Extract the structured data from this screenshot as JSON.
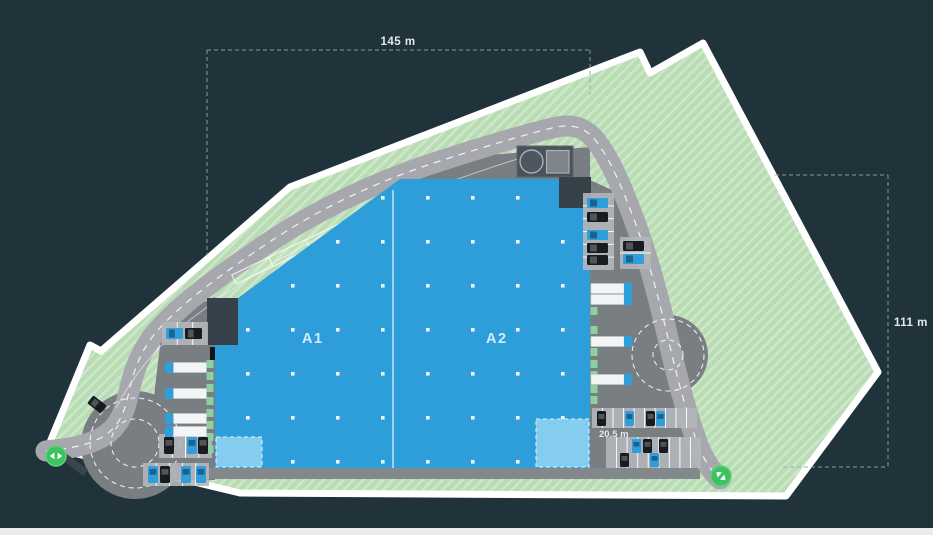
{
  "labels": {
    "dim_top": "145 m",
    "dim_right": "111 m",
    "dim_parking": "20.5 m",
    "hall_a1": "A1",
    "hall_a2": "A2"
  },
  "colors": {
    "bg": "#20323a",
    "boundary": "#ffffff",
    "green": "#b9dcb5",
    "green-light": "#cde7c9",
    "road": "#a6a8ad",
    "yard": "#797e83",
    "yard-light": "#83888d",
    "building": "#2d9ed9",
    "building-light": "#85cdee",
    "office-dark": "#36424a",
    "pad": "#49525a",
    "car-blue": "#2f9fdb",
    "car-dark": "#171c21",
    "truck-trailer": "#f2f4f5",
    "dock-green": "#8fd0a0",
    "marker-green": "#3ec161",
    "parking-base": "#b2b6ba",
    "dim-text": "#e2e9ec",
    "dash": "#9aa6ac",
    "bottom-strip": "#e9ebed"
  },
  "objects": {
    "parking_rows": [
      {
        "x": 162,
        "y": 322,
        "w": 46,
        "h": 23,
        "slots": 3,
        "dir": "v"
      },
      {
        "x": 159,
        "y": 434,
        "w": 53,
        "h": 24,
        "slots": 4,
        "dir": "v"
      },
      {
        "x": 143,
        "y": 463,
        "w": 66,
        "h": 23,
        "slots": 5,
        "dir": "v"
      },
      {
        "x": 583,
        "y": 193,
        "w": 31,
        "h": 77,
        "slots": 6,
        "dir": "h"
      },
      {
        "x": 620,
        "y": 237,
        "w": 31,
        "h": 32,
        "slots": 2,
        "dir": "h"
      },
      {
        "x": 592,
        "y": 408,
        "w": 105,
        "h": 20,
        "slots": 10,
        "dir": "v"
      },
      {
        "x": 606,
        "y": 437,
        "w": 95,
        "h": 16,
        "slots": 9,
        "dir": "v"
      },
      {
        "x": 606,
        "y": 453,
        "w": 95,
        "h": 15,
        "slots": 9,
        "dir": "v"
      }
    ],
    "docks_west_y": [
      360,
      372,
      384,
      397,
      409,
      421,
      433,
      445
    ],
    "docks_east_y": [
      285,
      296,
      307,
      326,
      337,
      348,
      360,
      371,
      385,
      396
    ],
    "trucks_west_y": [
      362,
      388,
      413,
      426
    ],
    "trucks_east_y": [
      283,
      294,
      336,
      374
    ],
    "cars": [
      {
        "x": 166,
        "y": 328,
        "w": 17,
        "h": 11,
        "color": "blue"
      },
      {
        "x": 185,
        "y": 328,
        "w": 17,
        "h": 11,
        "color": "dark"
      },
      {
        "x": 164,
        "y": 437,
        "w": 10,
        "h": 17,
        "color": "dark"
      },
      {
        "x": 187,
        "y": 437,
        "w": 10,
        "h": 17,
        "color": "blue"
      },
      {
        "x": 198,
        "y": 437,
        "w": 10,
        "h": 17,
        "color": "dark"
      },
      {
        "x": 148,
        "y": 466,
        "w": 10,
        "h": 17,
        "color": "blue"
      },
      {
        "x": 160,
        "y": 466,
        "w": 10,
        "h": 17,
        "color": "dark"
      },
      {
        "x": 181,
        "y": 466,
        "w": 10,
        "h": 17,
        "color": "blue"
      },
      {
        "x": 196,
        "y": 466,
        "w": 10,
        "h": 17,
        "color": "blue"
      },
      {
        "x": 587,
        "y": 198,
        "w": 21,
        "h": 10,
        "color": "blue"
      },
      {
        "x": 587,
        "y": 212,
        "w": 21,
        "h": 10,
        "color": "dark"
      },
      {
        "x": 587,
        "y": 230,
        "w": 21,
        "h": 10,
        "color": "blue"
      },
      {
        "x": 587,
        "y": 243,
        "w": 21,
        "h": 10,
        "color": "dark"
      },
      {
        "x": 587,
        "y": 255,
        "w": 21,
        "h": 10,
        "color": "dark"
      },
      {
        "x": 623,
        "y": 241,
        "w": 21,
        "h": 10,
        "color": "dark"
      },
      {
        "x": 623,
        "y": 254,
        "w": 21,
        "h": 10,
        "color": "blue"
      },
      {
        "x": 597,
        "y": 411,
        "w": 9,
        "h": 15,
        "color": "dark"
      },
      {
        "x": 625,
        "y": 411,
        "w": 9,
        "h": 15,
        "color": "blue"
      },
      {
        "x": 646,
        "y": 411,
        "w": 9,
        "h": 15,
        "color": "dark"
      },
      {
        "x": 656,
        "y": 411,
        "w": 9,
        "h": 15,
        "color": "blue"
      },
      {
        "x": 632,
        "y": 439,
        "w": 9,
        "h": 14,
        "color": "blue"
      },
      {
        "x": 643,
        "y": 439,
        "w": 9,
        "h": 14,
        "color": "dark"
      },
      {
        "x": 659,
        "y": 439,
        "w": 9,
        "h": 14,
        "color": "dark"
      },
      {
        "x": 620,
        "y": 453,
        "w": 9,
        "h": 14,
        "color": "dark"
      },
      {
        "x": 650,
        "y": 453,
        "w": 9,
        "h": 14,
        "color": "blue"
      },
      {
        "x": 92,
        "y": 396,
        "w": 10,
        "h": 17,
        "color": "dark",
        "rot": -52
      }
    ]
  }
}
